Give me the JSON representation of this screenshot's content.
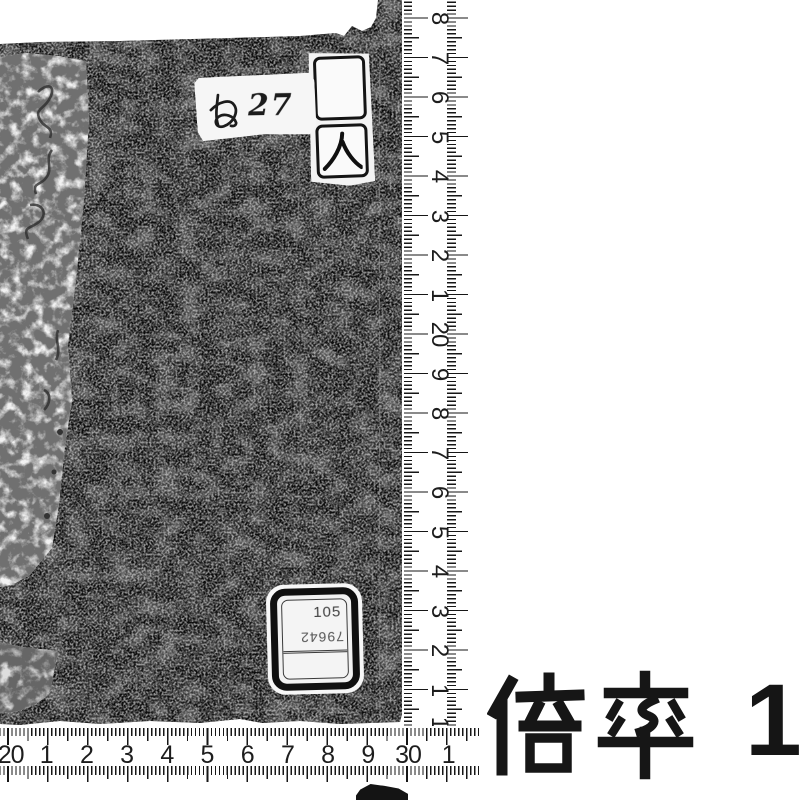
{
  "scene": {
    "description": "Monochrome archival photograph of a Japanese bound volume (black cover) with centimetre scales along its right and bottom edges",
    "background_color": "#ffffff",
    "book_color": "#0d0d0d"
  },
  "book": {
    "top_label": {
      "text": "ぬ27",
      "kana": "ぬ",
      "number": "27"
    },
    "call_label": {
      "text": "人"
    },
    "sticker": {
      "line1": "105",
      "line2": "79642",
      "line3": ""
    }
  },
  "vertical_ruler": {
    "unit": "cm",
    "labels": [
      "8",
      "7",
      "6",
      "5",
      "4",
      "3",
      "2",
      "1",
      "20",
      "9",
      "8",
      "7",
      "6",
      "5",
      "4",
      "3",
      "2",
      "1",
      "10"
    ],
    "start": 18,
    "step": 39.5
  },
  "horizontal_ruler": {
    "unit": "cm",
    "labels": [
      "20",
      "1",
      "2",
      "3",
      "4",
      "5",
      "6",
      "7",
      "8",
      "9",
      "30",
      "1"
    ],
    "start": 6,
    "step": 40.2
  },
  "magnification": {
    "label": "倍率",
    "value": "1/"
  }
}
